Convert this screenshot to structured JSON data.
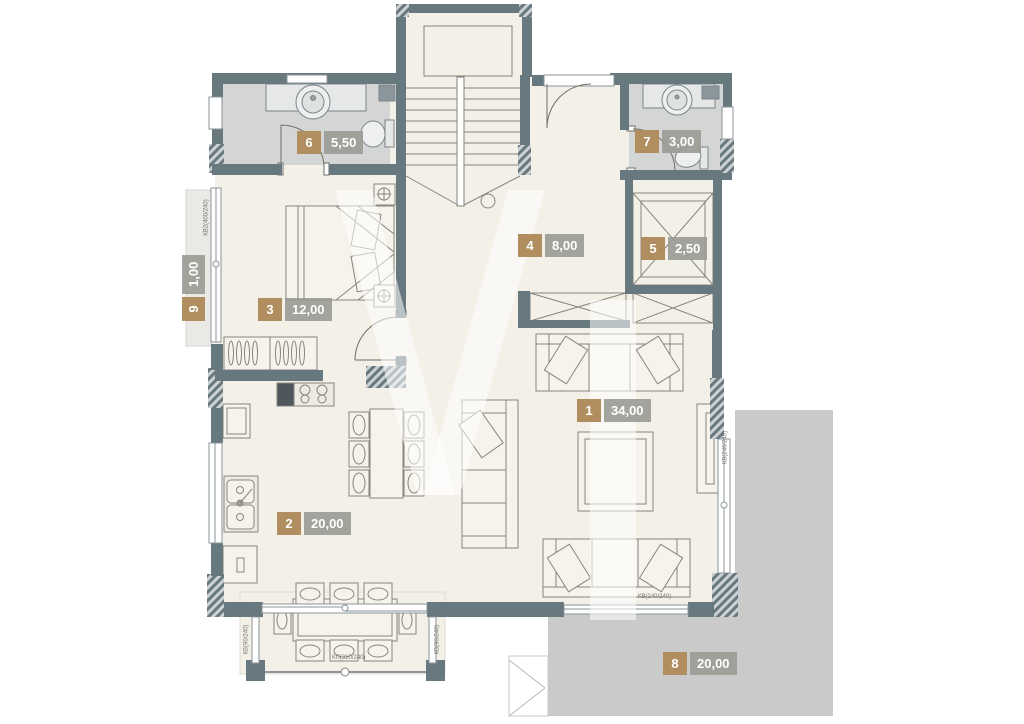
{
  "rooms": [
    {
      "number": "1",
      "area": "34,00"
    },
    {
      "number": "2",
      "area": "20,00"
    },
    {
      "number": "3",
      "area": "12,00"
    },
    {
      "number": "4",
      "area": "8,00"
    },
    {
      "number": "5",
      "area": "2,50"
    },
    {
      "number": "6",
      "area": "5,50"
    },
    {
      "number": "7",
      "area": "3,00"
    },
    {
      "number": "8",
      "area": "20,00"
    },
    {
      "number": "9",
      "area": "1,00"
    }
  ],
  "annotations": {
    "balcony_door": "КП(310/240)",
    "bedroom_window": "КВ2(400/240)",
    "living_bottom_window": "КВ(240/240)",
    "living_right_window": "КВ(240/240)",
    "balcony_left_window": "КВ(90/240)",
    "balcony_right_window": "КВ(90/240)"
  },
  "colors": {
    "wall": "#68787f",
    "floor": "#f3f0e8",
    "wet_floor": "#d4d5d5",
    "terrace": "#cacaca",
    "room_number_bg": "#b18e5f",
    "room_area_bg": "#9c9c96"
  }
}
